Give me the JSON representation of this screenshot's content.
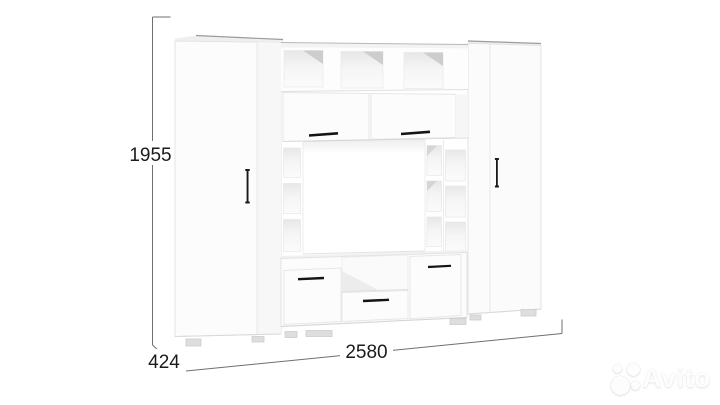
{
  "page": {
    "background": "#ffffff"
  },
  "dimensions": {
    "height": "1955",
    "depth": "424",
    "width": "2580"
  },
  "annotation": {
    "line_color": "#6f6f6f",
    "text_color": "#1b1b1b"
  },
  "furniture": {
    "body_color": "#fcfcfc",
    "edge_color": "#e3e3e3",
    "handle_color": "#1a1a1a",
    "feet_color": "#dedede"
  },
  "watermark": {
    "brand": "Avito",
    "color": "#fdfdfd"
  }
}
